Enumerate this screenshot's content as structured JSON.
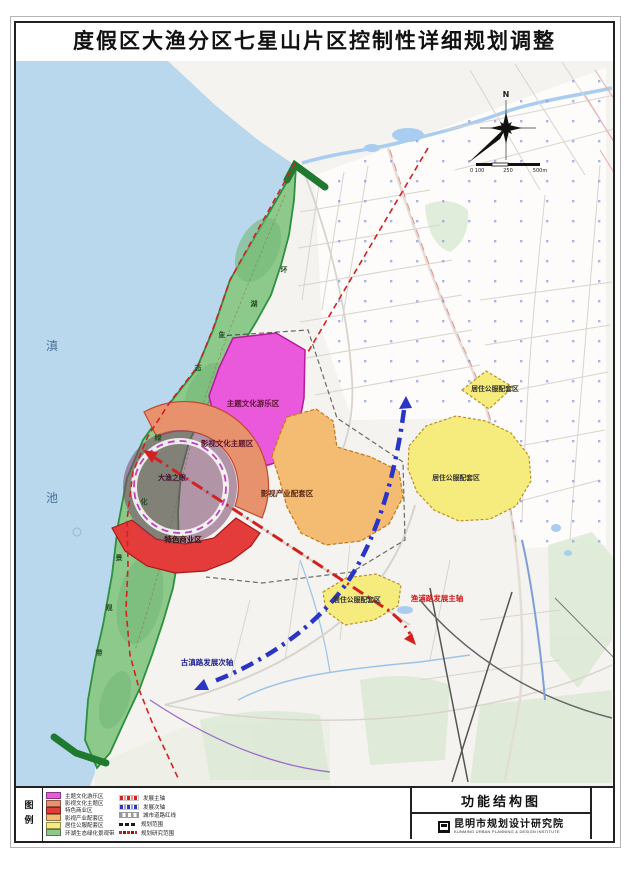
{
  "page": {
    "title": "度假区大渔分区七星山片区控制性详细规划调整"
  },
  "map": {
    "lake_chars": [
      "滇",
      "池"
    ],
    "belt_chars": [
      "环",
      "湖",
      "生",
      "态",
      "绿",
      "化",
      "景",
      "观",
      "带"
    ],
    "zones": {
      "theme_park": "主题文化游乐区",
      "film_culture": "影视文化主题区",
      "dayu_eye": "大渔之眼",
      "special_business": "特色商业区",
      "film_industry": "影视产业配套区",
      "residential_1": "居住公服配套区",
      "residential_2": "居住公服配套区",
      "residential_3": "居住公服配套区"
    },
    "axes": {
      "main": "渔浦路发展主轴",
      "secondary": "古滇路发展次轴"
    },
    "compass_n": "N",
    "scale": {
      "left": "0 100",
      "mid": "250",
      "right": "500m"
    }
  },
  "legend": {
    "header": "图例",
    "zone_items": [
      {
        "label": "主题文化游乐区",
        "color": "#ea58dc"
      },
      {
        "label": "影视文化主题区",
        "color": "#e8916d"
      },
      {
        "label": "特色商业区",
        "color": "#e43b3b"
      },
      {
        "label": "影视产业配套区",
        "color": "#f3bc72"
      },
      {
        "label": "居住公服配套区",
        "color": "#f6ec7d"
      },
      {
        "label": "环湖生态绿化景观带",
        "color": "#8cc98a"
      }
    ],
    "line_items": [
      {
        "label": "发展主轴",
        "color": "#d42020",
        "style": "dash-dot"
      },
      {
        "label": "发展次轴",
        "color": "#2a35c8",
        "style": "dash-dot"
      },
      {
        "label": "城市道路红线",
        "color": "#9a9a9a",
        "style": "double-dash"
      },
      {
        "label": "规划范围",
        "color": "#1a1a1a",
        "style": "dash"
      },
      {
        "label": "规划研究范围",
        "color": "#d42020",
        "style": "dash"
      }
    ]
  },
  "titleblock": {
    "drawing_title": "功能结构图",
    "institute": "昆明市规划设计研究院",
    "institute_en": "KUNMING URBAN PLANNING & DESIGN INSTITUTE"
  },
  "colors": {
    "lake": "#b9d8ee",
    "greenbelt": "#8cc98a",
    "axis_main": "#d42020",
    "axis_secondary": "#2a35c8"
  }
}
